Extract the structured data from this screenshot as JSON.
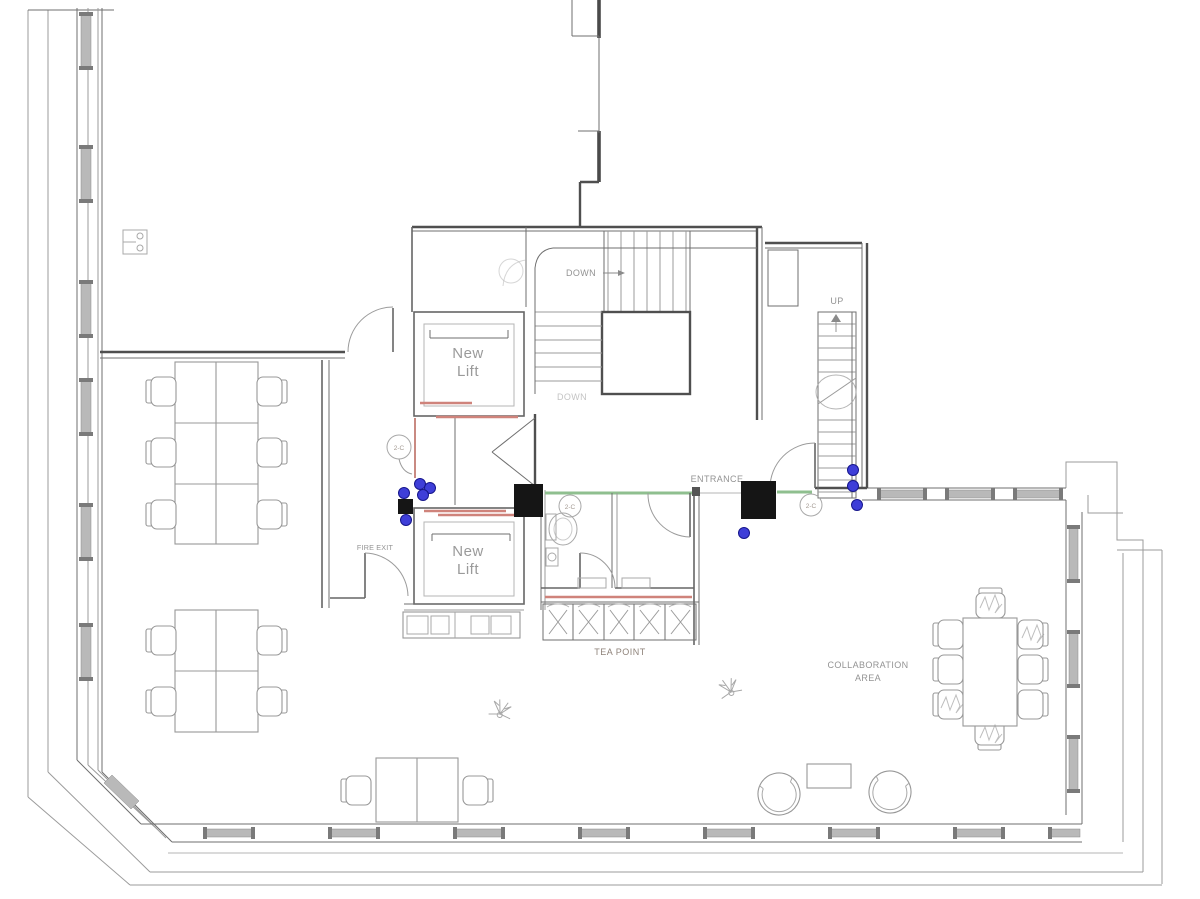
{
  "drawing_type": "architectural-floor-plan",
  "labels": {
    "new_lift_line1": "New",
    "new_lift_line2": "Lift",
    "down_upper": "DOWN",
    "down_lower": "DOWN",
    "up": "UP",
    "entrance": "ENTRANCE",
    "fire_exit": "FIRE EXIT",
    "tea_point": "TEA POINT",
    "collaboration_line1": "COLLABORATION",
    "collaboration_line2": "AREA",
    "door_tag": "2-C"
  },
  "elements": {
    "lifts": 2,
    "stair_flights": 2,
    "wc_cubicles": 2,
    "tea_point_units": 5,
    "office_desk_seats": 12,
    "meeting_table_seats": 8,
    "lounge_chairs": 2,
    "plants": 2,
    "structural_columns": 3,
    "blue_markers": 9,
    "door_tags": 3
  },
  "colors": {
    "wall": "#6f6f6f",
    "furniture": "#989898",
    "lift_door_accent": "#cf837b",
    "glazing_accent": "#8fbf8f",
    "marker_blue": "#3e3ed8",
    "column_black": "#151515",
    "label_text": "#939393",
    "window_mullion": "#b9b9b9"
  }
}
